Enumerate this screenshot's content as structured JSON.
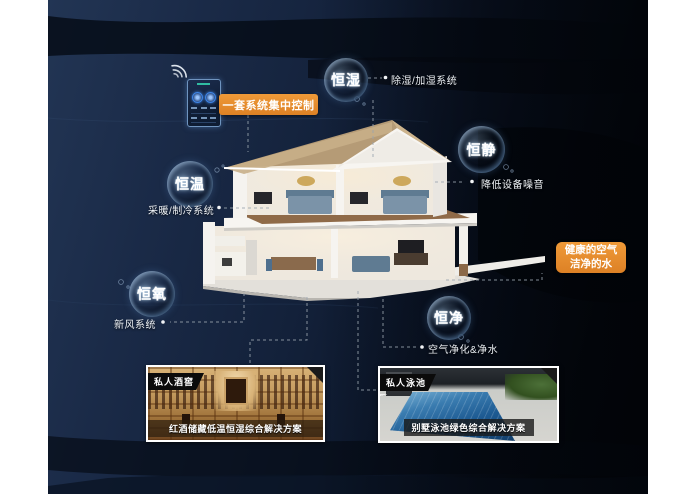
{
  "scene": {
    "description": "smart-villa constant-climate system infographic",
    "colors": {
      "background_navy": "#13213a",
      "background_black": "#04070c",
      "accent_orange": "#e2882b",
      "label_text": "#eef2f6",
      "bubble_glow": "#9cc6ff"
    }
  },
  "controller": {
    "badge_label": "一套系统集中控制",
    "device": "wall-mounted smart control panel",
    "wifi_icon": "wifi-signal"
  },
  "bubbles": [
    {
      "id": "hengshi",
      "label": "恒湿",
      "note": "除湿/加湿系统"
    },
    {
      "id": "hengjing",
      "label": "恒静",
      "note": "降低设备噪音"
    },
    {
      "id": "hengwen",
      "label": "恒温",
      "note": "采暖/制冷系统"
    },
    {
      "id": "hengyang",
      "label": "恒氧",
      "note": "新风系统"
    },
    {
      "id": "hengjin",
      "label": "恒净",
      "note": "空气净化&净水"
    }
  ],
  "highlight_box": {
    "line1": "健康的空气",
    "line2": "洁净的水"
  },
  "photos": [
    {
      "tag": "私人酒窖",
      "caption": "红酒储藏低温恒湿综合解决方案"
    },
    {
      "tag": "私人泳池",
      "caption": "别墅泳池绿色综合解决方案"
    }
  ]
}
